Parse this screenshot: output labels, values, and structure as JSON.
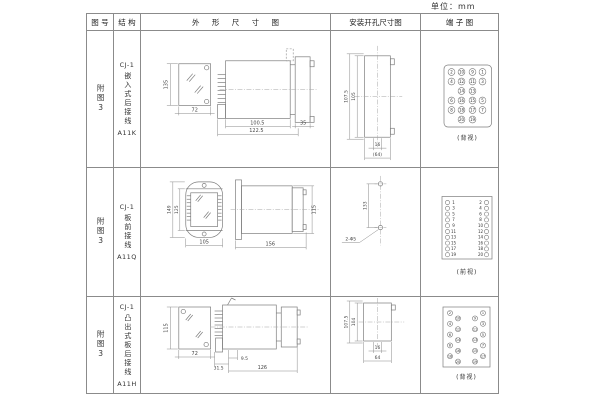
{
  "unit_label": "单位：mm",
  "headers": {
    "fig": "图 号",
    "struct": "结 构",
    "outline": "外 形 尺 寸 图",
    "mount": "安装开孔尺寸图",
    "terminal": "端 子 图"
  },
  "rows": [
    {
      "fig": "附图3",
      "model": "CJ-1",
      "desc": "嵌入式后接线",
      "code": "A11K",
      "dims": {
        "front_h": "135",
        "front_w": "72",
        "depth": "100.5",
        "depth_total": "122.5",
        "flange": "35"
      },
      "mount": {
        "v_outer": "107.5",
        "v_inner": "105",
        "h_inner": "16",
        "h_outer": "(64)"
      },
      "terminal_view": "(背视)"
    },
    {
      "fig": "附图3",
      "model": "CJ-1",
      "desc": "板前接线",
      "code": "A11Q",
      "dims": {
        "front_h_outer": "149",
        "front_h_inner": "125",
        "front_w": "105",
        "side_len": "156",
        "side_h": "115"
      },
      "mount": {
        "v": "133",
        "holes": "2-Φ5"
      },
      "terminal_view": "(前视)"
    },
    {
      "fig": "附图3",
      "model": "CJ-1",
      "desc": "凸出式板后接线",
      "code": "A11H",
      "dims": {
        "front_h": "115",
        "front_w": "72",
        "d1": "31.5",
        "d2": "9.5",
        "d3": "126"
      },
      "mount": {
        "v_outer": "107.5",
        "v_inner": "104",
        "h_inner": "16",
        "h_outer": "64"
      },
      "terminal_view": "(背视)"
    }
  ],
  "terminals": {
    "r1": {
      "r": 3.4,
      "dy": 1.4,
      "cls": "",
      "items": [
        {
          "x": 29.5,
          "y": 29,
          "n": "2"
        },
        {
          "x": 39.5,
          "y": 29,
          "n": "10"
        },
        {
          "x": 50.5,
          "y": 29,
          "n": "9"
        },
        {
          "x": 60.5,
          "y": 29,
          "n": "1"
        },
        {
          "x": 29.5,
          "y": 38.5,
          "n": "4"
        },
        {
          "x": 39.5,
          "y": 38.5,
          "n": "12"
        },
        {
          "x": 50.5,
          "y": 38.5,
          "n": "11"
        },
        {
          "x": 60.5,
          "y": 38.5,
          "n": "3"
        },
        {
          "x": 39.5,
          "y": 48,
          "n": "14"
        },
        {
          "x": 50.5,
          "y": 48,
          "n": "13"
        },
        {
          "x": 29.5,
          "y": 57.5,
          "n": "6"
        },
        {
          "x": 39.5,
          "y": 57.5,
          "n": "16"
        },
        {
          "x": 50.5,
          "y": 57.5,
          "n": "15"
        },
        {
          "x": 60.5,
          "y": 57.5,
          "n": "5"
        },
        {
          "x": 29.5,
          "y": 67,
          "n": "8"
        },
        {
          "x": 39.5,
          "y": 67,
          "n": "18"
        },
        {
          "x": 50.5,
          "y": 67,
          "n": "17"
        },
        {
          "x": 60.5,
          "y": 67,
          "n": "7"
        },
        {
          "x": 39.5,
          "y": 76.5,
          "n": "20"
        },
        {
          "x": 50.5,
          "y": 76.5,
          "n": "19"
        }
      ]
    },
    "r2": {
      "r": 2.1,
      "dy": 1.3,
      "cls": "",
      "items": [
        {
          "x": 25.5,
          "tx": 31.5,
          "y": 20.5,
          "n": "1"
        },
        {
          "x": 64.5,
          "tx": 58.5,
          "y": 20.5,
          "n": "2"
        },
        {
          "x": 25.5,
          "tx": 31.5,
          "y": 26.3,
          "n": "3"
        },
        {
          "x": 64.5,
          "tx": 58.5,
          "y": 26.3,
          "n": "4"
        },
        {
          "x": 25.5,
          "tx": 31.5,
          "y": 32.1,
          "n": "5"
        },
        {
          "x": 64.5,
          "tx": 58.5,
          "y": 32.1,
          "n": "6"
        },
        {
          "x": 25.5,
          "tx": 31.5,
          "y": 37.9,
          "n": "7"
        },
        {
          "x": 64.5,
          "tx": 58.5,
          "y": 37.9,
          "n": "8"
        },
        {
          "x": 25.5,
          "tx": 31.5,
          "y": 43.7,
          "n": "9"
        },
        {
          "x": 64.5,
          "tx": 58.5,
          "y": 43.7,
          "n": "10"
        },
        {
          "x": 25.5,
          "tx": 31.5,
          "y": 49.5,
          "n": "11"
        },
        {
          "x": 64.5,
          "tx": 58.5,
          "y": 49.5,
          "n": "12"
        },
        {
          "x": 25.5,
          "tx": 31.5,
          "y": 55.3,
          "n": "13"
        },
        {
          "x": 64.5,
          "tx": 58.5,
          "y": 55.3,
          "n": "14"
        },
        {
          "x": 25.5,
          "tx": 31.5,
          "y": 61.1,
          "n": "15"
        },
        {
          "x": 64.5,
          "tx": 58.5,
          "y": 61.1,
          "n": "16"
        },
        {
          "x": 25.5,
          "tx": 31.5,
          "y": 66.9,
          "n": "17"
        },
        {
          "x": 64.5,
          "tx": 58.5,
          "y": 66.9,
          "n": "18"
        },
        {
          "x": 25.5,
          "tx": 31.5,
          "y": 72.7,
          "n": "19"
        },
        {
          "x": 64.5,
          "tx": 58.5,
          "y": 72.7,
          "n": "20"
        }
      ]
    },
    "r3": {
      "r": 2.5,
      "dy": 1.2,
      "cls": "tn-xs",
      "items": [
        {
          "x": 28,
          "y": 10,
          "n": "2"
        },
        {
          "x": 61,
          "y": 10,
          "n": "1"
        },
        {
          "x": 36,
          "y": 15.4,
          "n": "10"
        },
        {
          "x": 53,
          "y": 15.4,
          "n": "9"
        },
        {
          "x": 28,
          "y": 20.8,
          "n": "4"
        },
        {
          "x": 61,
          "y": 20.8,
          "n": "3"
        },
        {
          "x": 36,
          "y": 26.2,
          "n": "12"
        },
        {
          "x": 53,
          "y": 26.2,
          "n": "11"
        },
        {
          "x": 28,
          "y": 31.6,
          "n": "6"
        },
        {
          "x": 61,
          "y": 31.6,
          "n": "5"
        },
        {
          "x": 36,
          "y": 37,
          "n": "14"
        },
        {
          "x": 53,
          "y": 37,
          "n": "13"
        },
        {
          "x": 28,
          "y": 42.4,
          "n": "8"
        },
        {
          "x": 61,
          "y": 42.4,
          "n": "7"
        },
        {
          "x": 36,
          "y": 47.8,
          "n": "16"
        },
        {
          "x": 53,
          "y": 47.8,
          "n": "15"
        },
        {
          "x": 28,
          "y": 53.2,
          "n": "18"
        },
        {
          "x": 61,
          "y": 53.2,
          "n": "17"
        },
        {
          "x": 36,
          "y": 58.6,
          "n": "20"
        },
        {
          "x": 53,
          "y": 58.6,
          "n": "19"
        }
      ]
    }
  }
}
